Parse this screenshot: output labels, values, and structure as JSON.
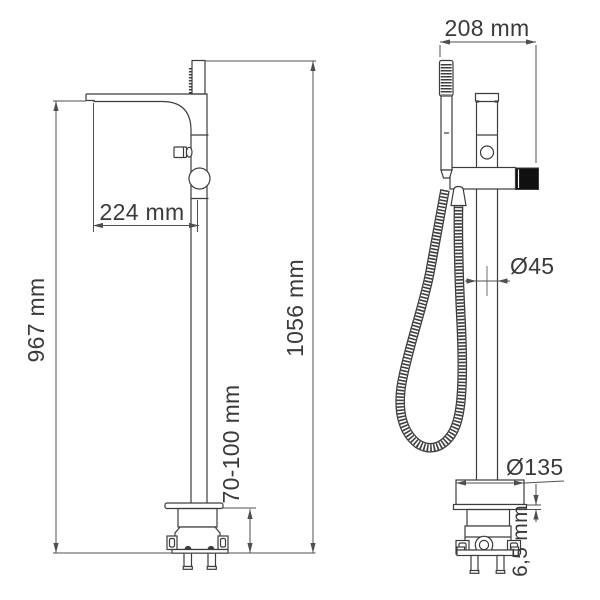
{
  "drawing": {
    "description": "Technical dimension drawing of a freestanding floor-mounted bath mixer tap, side view and front view with hand shower",
    "labels": {
      "spout_reach": "224 mm",
      "spout_height": "967 mm",
      "total_height": "1056 mm",
      "floor_mount_range": "70-100 mm",
      "top_width": "208 mm",
      "column_diameter": "Ø45",
      "base_diameter": "Ø135",
      "plate_thickness": "6,5 mm"
    },
    "colors": {
      "background": "#ffffff",
      "outline": "#3d3d3d",
      "dimension_line": "#4f4f4f",
      "text": "#3a3a3a",
      "knob_fill": "#101010"
    }
  }
}
